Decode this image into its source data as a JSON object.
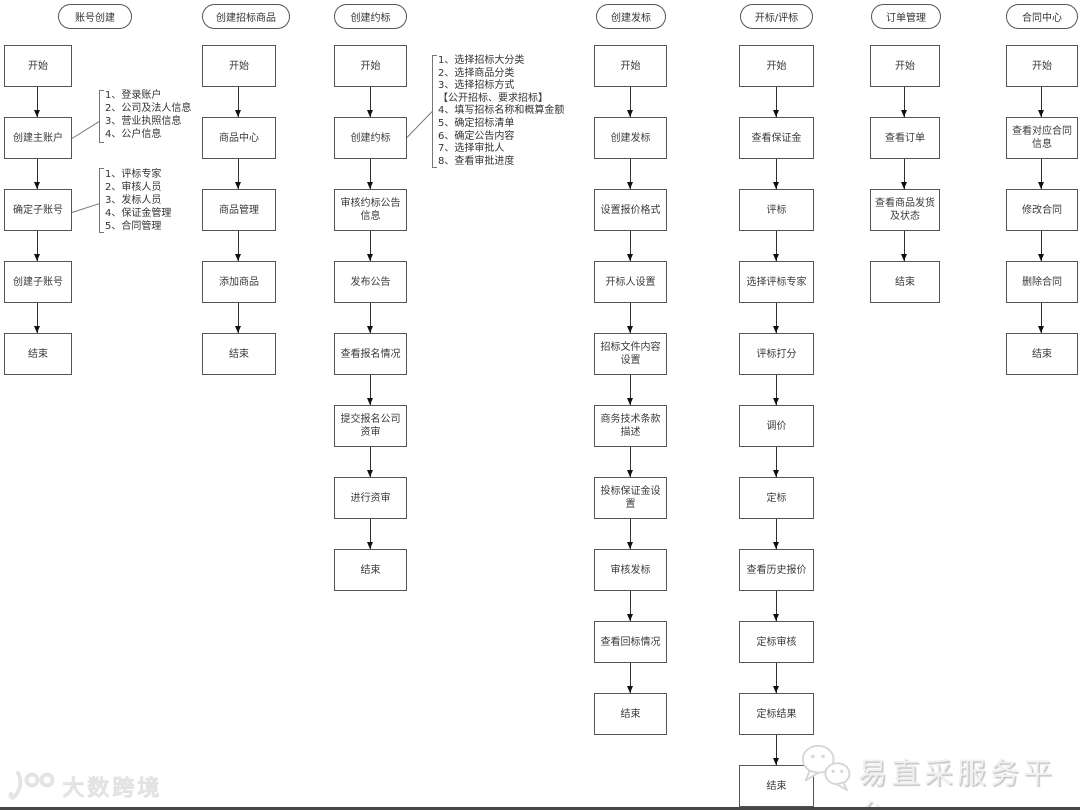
{
  "columns": [
    {
      "title": "账号创建",
      "nodes": [
        "开始",
        "创建主账户",
        "确定子账号",
        "创建子账号",
        "结束"
      ],
      "notes": [
        {
          "lines": [
            "1、登录账户",
            "2、公司及法人信息",
            "3、营业执照信息",
            "4、公户信息"
          ]
        },
        {
          "lines": [
            "1、评标专家",
            "2、审核人员",
            "3、发标人员",
            "4、保证金管理",
            "5、合同管理"
          ]
        }
      ]
    },
    {
      "title": "创建招标商品",
      "nodes": [
        "开始",
        "商品中心",
        "商品管理",
        "添加商品",
        "结束"
      ]
    },
    {
      "title": "创建约标",
      "nodes": [
        "开始",
        "创建约标",
        "审核约标公告信息",
        "发布公告",
        "查看报名情况",
        "提交报名公司资审",
        "进行资审",
        "结束"
      ],
      "notes": [
        {
          "lines": [
            "1、选择招标大分类",
            "2、选择商品分类",
            "3、选择招标方式",
            "【公开招标、要求招标】",
            "4、填写招标名称和概算金额",
            "5、确定招标清单",
            "6、确定公告内容",
            "7、选择审批人",
            "8、查看审批进度"
          ]
        }
      ]
    },
    {
      "title": "创建发标",
      "nodes": [
        "开始",
        "创建发标",
        "设置报价格式",
        "开标人设置",
        "招标文件内容设置",
        "商务技术条款描述",
        "投标保证金设置",
        "审核发标",
        "查看回标情况",
        "结束"
      ]
    },
    {
      "title": "开标/评标",
      "nodes": [
        "开始",
        "查看保证金",
        "评标",
        "选择评标专家",
        "评标打分",
        "调价",
        "定标",
        "查看历史报价",
        "定标审核",
        "定标结果",
        "结束"
      ]
    },
    {
      "title": "订单管理",
      "nodes": [
        "开始",
        "查看订单",
        "查看商品发货及状态",
        "结束"
      ]
    },
    {
      "title": "合同中心",
      "nodes": [
        "开始",
        "查看对应合同信息",
        "修改合同",
        "删除合同",
        "结束"
      ]
    }
  ],
  "watermarks": {
    "left": {
      "text": "大数跨境"
    },
    "right": {
      "text": "易直采服务平台"
    }
  },
  "colors": {
    "box_border": "#555555",
    "arrow": "#111111",
    "watermark_left": "#e4e4e4",
    "watermark_right": "#f0f0f0"
  }
}
